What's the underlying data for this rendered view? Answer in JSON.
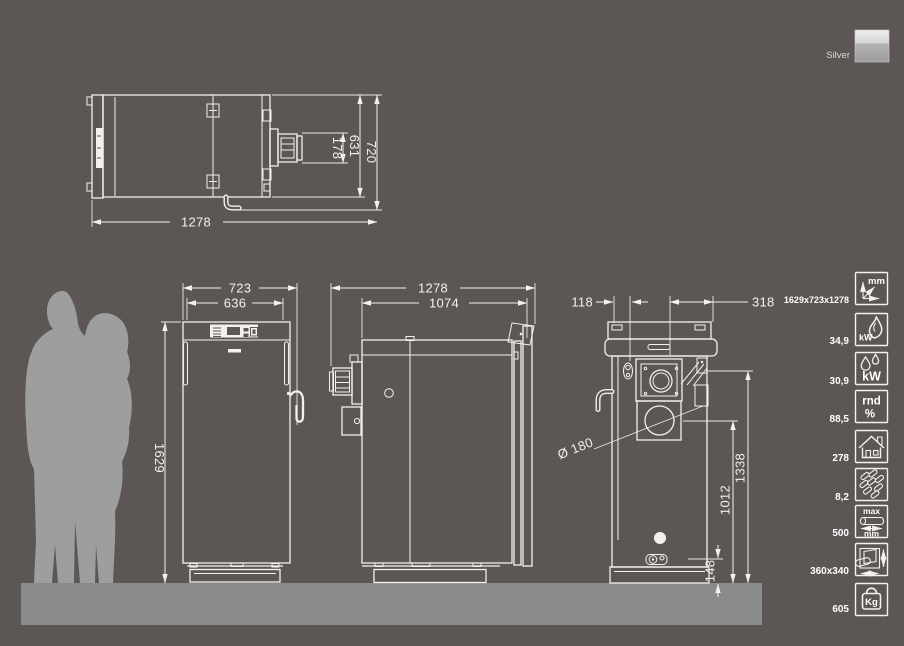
{
  "colors": {
    "bg": "#5c5755",
    "floor": "#8b8b8b",
    "figure": "#9e9e9e",
    "line": "#f2f1ef",
    "value_text": "#ffffff",
    "silver_label": "#d9d9d9",
    "swatch_top": "#efefef",
    "swatch_bottom": "#9c9c9c"
  },
  "color_option": {
    "label": "Silver",
    "swatch_icon": "silver-swatch"
  },
  "dim_labels": {
    "top_depth": "1278",
    "top_total": "720",
    "top_body": "631",
    "top_fan": "178",
    "front_width_total": "723",
    "front_width_body": "636",
    "front_height": "1629",
    "side_depth_total": "1278",
    "side_depth_body": "1074",
    "rear_offset_left": "118",
    "rear_offset_right": "318",
    "flue_diameter": "Ø 180",
    "rear_height_top": "1338",
    "rear_height_flue": "1012",
    "rear_height_drain": "148"
  },
  "specs": [
    {
      "icon": "dimensions-mm-icon",
      "unit": "mm",
      "value": "1629x723x1278"
    },
    {
      "icon": "flame-kw-icon",
      "unit": "kW",
      "value": "34,9"
    },
    {
      "icon": "waterdrops-kw-icon",
      "unit": "kW",
      "value": "30,9"
    },
    {
      "icon": "efficiency-rnd-percent-icon",
      "unit_top": "rnd",
      "unit_bottom": "%",
      "value": "88,5"
    },
    {
      "icon": "house-icon",
      "value": "278"
    },
    {
      "icon": "pellets-icon",
      "value": "8,2"
    },
    {
      "icon": "max-log-length-icon",
      "unit_top": "max",
      "unit_bottom": "mm",
      "value": "500"
    },
    {
      "icon": "door-opening-icon",
      "value": "360x340"
    },
    {
      "icon": "weight-kg-icon",
      "unit": "Kg",
      "value": "605"
    }
  ]
}
